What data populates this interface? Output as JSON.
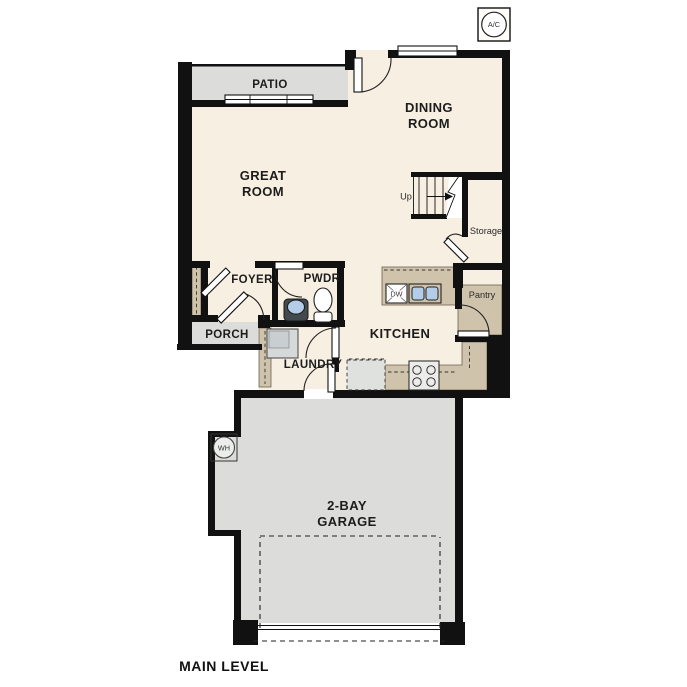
{
  "plan": {
    "title": "MAIN LEVEL",
    "labels": {
      "ac_unit": "A/C",
      "patio": "PATIO",
      "dining_line1": "DINING",
      "dining_line2": "ROOM",
      "great_line1": "GREAT",
      "great_line2": "ROOM",
      "stairs_up": "Up",
      "storage": "Storage",
      "foyer": "FOYER",
      "powder_room": "PWDR",
      "porch": "PORCH",
      "kitchen": "KITCHEN",
      "pantry": "Pantry",
      "dishwasher": "DW",
      "laundry": "LAUNDRY",
      "water_heater": "WH",
      "garage_line1": "2-BAY",
      "garage_line2": "GARAGE",
      "main_level": "MAIN LEVEL"
    },
    "colors": {
      "interior_floor": "#f7efe1",
      "exterior_concrete": "#dcdcda",
      "cabinetry": "#d0c3ab",
      "walls": "#111111",
      "sink_blue": "#b3cde9",
      "background": "#ffffff"
    }
  }
}
